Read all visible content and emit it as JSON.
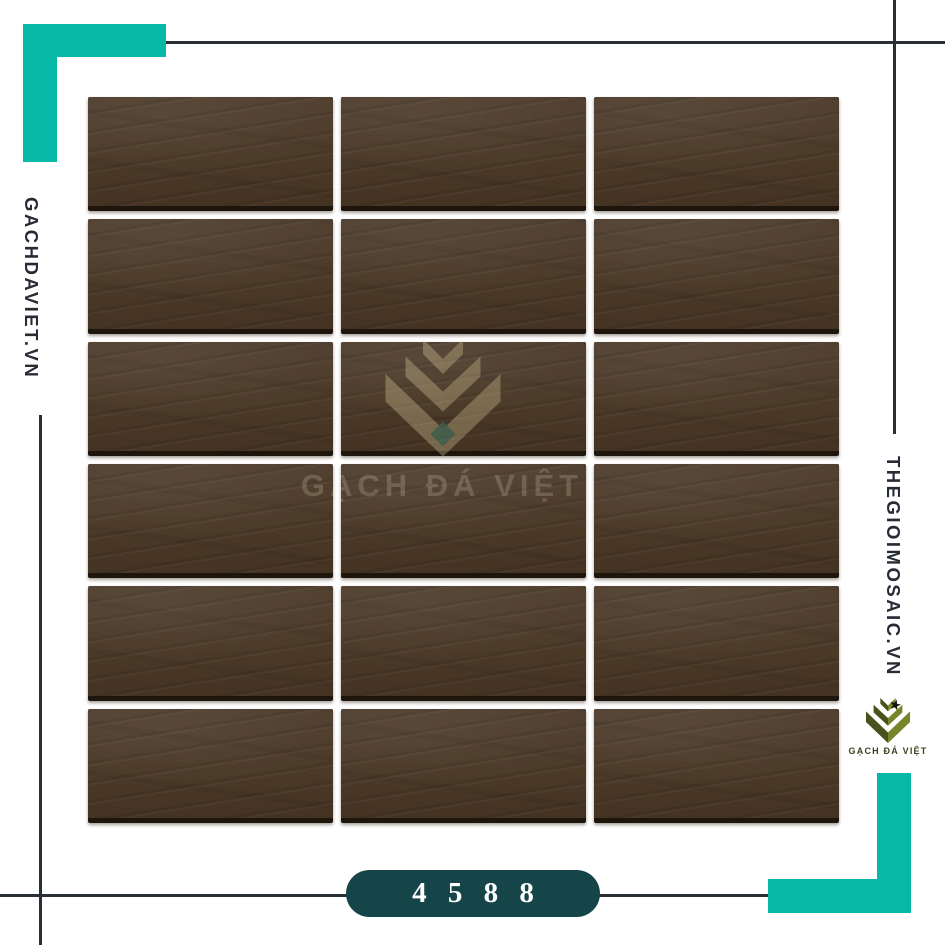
{
  "branding": {
    "left_site": "GACHDAVIET.VN",
    "right_site": "THEGIOIMOSAIC.VN",
    "logo_text": "GẠCH ĐÁ VIỆT",
    "watermark_text": "GẠCH ĐÁ VIỆT",
    "star_icon": "★"
  },
  "product": {
    "code": "4 5 8 8",
    "grid": {
      "rows": 6,
      "cols": 3,
      "tile_count": 18
    }
  },
  "colors": {
    "accent_teal": "#05b9a6",
    "badge_bg": "#164549",
    "rule_line": "#2a2e36",
    "tile_brown": "#4b3a28",
    "tile_bottom_edge": "#1e160d",
    "logo_olive_dark": "#47521c",
    "logo_olive_light": "#76862a",
    "text_dark": "#262b35"
  }
}
